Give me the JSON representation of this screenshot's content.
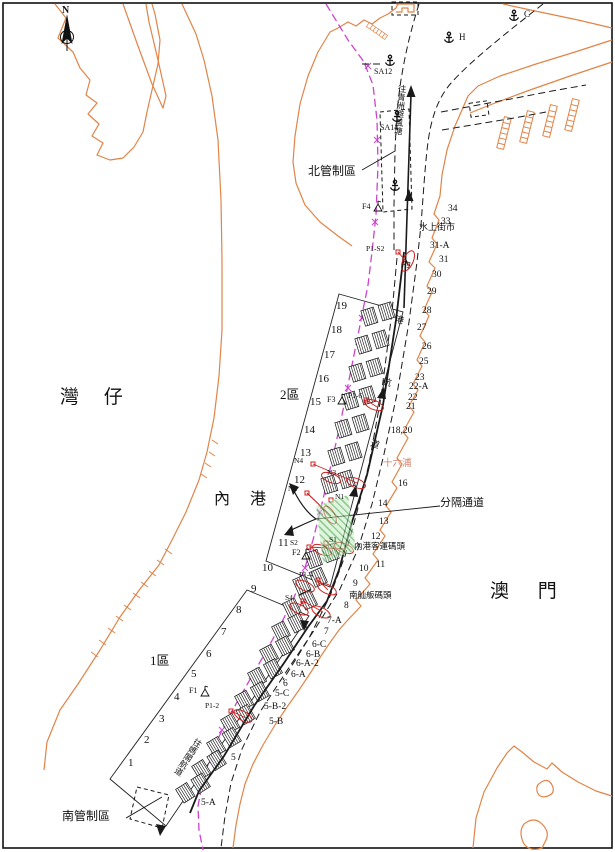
{
  "colors": {
    "coast": "#e08448",
    "boundary": "#cc44cc",
    "marker_red": "#cc2222",
    "separation_fill": "#c6ecc6",
    "separation_hatch": "#3aa53a",
    "line": "#1a1a1a"
  },
  "labels": [
    {
      "n": "compass-label",
      "t": "N",
      "x": 62,
      "y": 6,
      "s": 10,
      "b": 1
    },
    {
      "n": "region-wanzai",
      "t": "灣 仔",
      "x": 60,
      "y": 388,
      "s": 19,
      "ls": 10
    },
    {
      "n": "region-neigang",
      "t": "內 港",
      "x": 214,
      "y": 492,
      "s": 16,
      "ls": 8
    },
    {
      "n": "region-aomen",
      "t": "澳 門",
      "x": 490,
      "y": 582,
      "s": 19,
      "ls": 12
    },
    {
      "n": "zone-2-label",
      "t": "2區",
      "x": 280,
      "y": 388,
      "s": 13
    },
    {
      "n": "zone-1-label",
      "t": "1區",
      "x": 150,
      "y": 654,
      "s": 13
    },
    {
      "n": "north-control-zone-label",
      "t": "北管制區",
      "x": 308,
      "y": 165,
      "s": 12
    },
    {
      "n": "south-control-zone-label",
      "t": "南管制區",
      "x": 62,
      "y": 810,
      "s": 12
    },
    {
      "n": "separation-channel-label",
      "t": "分隔通道",
      "x": 440,
      "y": 498,
      "s": 11
    },
    {
      "n": "water-street-market-label",
      "t": "水上街市",
      "x": 419,
      "y": 223,
      "s": 9
    },
    {
      "n": "ponte16-label",
      "t": "十六浦",
      "x": 383,
      "y": 460,
      "s": 9.5,
      "c": "#d4826a"
    },
    {
      "n": "inner-harbour-ferry-pier-label",
      "t": "內港客運碼頭",
      "x": 354,
      "y": 542,
      "s": 8.5
    },
    {
      "n": "south-sampan-pier-label",
      "t": "南舢舨碼頭",
      "x": 349,
      "y": 591,
      "s": 8.5
    },
    {
      "n": "to-qingzhou-shelter-label",
      "t": "往青洲避風塘",
      "x": 398,
      "y": 84,
      "s": 8.5,
      "v": 1,
      "r": 5
    },
    {
      "n": "channel-name-char",
      "t": "內",
      "x": 403,
      "y": 259,
      "s": 9,
      "r": 15
    },
    {
      "n": "channel-name-char",
      "t": "港",
      "x": 396,
      "y": 315,
      "s": 9,
      "r": 15
    },
    {
      "n": "channel-name-char",
      "t": "航",
      "x": 384,
      "y": 377,
      "s": 9,
      "r": 18
    },
    {
      "n": "channel-name-char",
      "t": "道",
      "x": 372,
      "y": 439,
      "s": 9,
      "r": 18
    },
    {
      "n": "to-mage-channel-label",
      "t": "往媽閣航道",
      "x": 196,
      "y": 737,
      "s": 8.5,
      "v": 1,
      "r": 33
    },
    {
      "n": "anchorage-c-label",
      "t": "C",
      "x": 524,
      "y": 10,
      "s": 9
    },
    {
      "n": "anchorage-h-label",
      "t": "H",
      "x": 459,
      "y": 33,
      "s": 9
    },
    {
      "n": "marker-sa12-label",
      "t": "SA12",
      "x": 374,
      "y": 68,
      "s": 8
    },
    {
      "n": "marker-sa14-label",
      "t": "SA14",
      "x": 380,
      "y": 124,
      "s": 8
    },
    {
      "n": "marker-f4-label",
      "t": "F4",
      "x": 362,
      "y": 203,
      "s": 8
    },
    {
      "n": "marker-f3-label",
      "t": "F3",
      "x": 327,
      "y": 396,
      "s": 8
    },
    {
      "n": "marker-f2-label",
      "t": "F2",
      "x": 292,
      "y": 549,
      "s": 8
    },
    {
      "n": "marker-f1-label",
      "t": "F1",
      "x": 189,
      "y": 687,
      "s": 8
    },
    {
      "n": "marker-n4-label",
      "t": "N4",
      "x": 294,
      "y": 457,
      "s": 7.5
    },
    {
      "n": "marker-n3-label",
      "t": "N3",
      "x": 327,
      "y": 469,
      "s": 7.5
    },
    {
      "n": "marker-n2-label",
      "t": "N2",
      "x": 288,
      "y": 485,
      "s": 7.5
    },
    {
      "n": "marker-n1-label",
      "t": "N1",
      "x": 335,
      "y": 493,
      "s": 7.5
    },
    {
      "n": "marker-s2-label",
      "t": "S2",
      "x": 290,
      "y": 539,
      "s": 7.5
    },
    {
      "n": "marker-s1-label",
      "t": "S1",
      "x": 329,
      "y": 536,
      "s": 7.5
    },
    {
      "n": "marker-s4-label",
      "t": "S4",
      "x": 285,
      "y": 594,
      "s": 7.5
    },
    {
      "n": "marker-p1s2-label",
      "t": "P1-S2",
      "x": 366,
      "y": 245,
      "s": 7.5
    },
    {
      "n": "marker-p1-6-label",
      "t": "P1-6",
      "x": 348,
      "y": 392,
      "s": 7.5
    },
    {
      "n": "marker-p1-4-label",
      "t": "P1-4",
      "x": 299,
      "y": 571,
      "s": 7.5
    },
    {
      "n": "marker-p1-2-label",
      "t": "P1-2",
      "x": 205,
      "y": 702,
      "s": 7.5
    },
    {
      "n": "berth-19",
      "t": "19",
      "x": 336,
      "y": 301,
      "s": 11
    },
    {
      "n": "berth-18",
      "t": "18",
      "x": 331,
      "y": 325,
      "s": 11
    },
    {
      "n": "berth-17",
      "t": "17",
      "x": 324,
      "y": 350,
      "s": 11
    },
    {
      "n": "berth-16",
      "t": "16",
      "x": 318,
      "y": 374,
      "s": 11
    },
    {
      "n": "berth-15",
      "t": "15",
      "x": 310,
      "y": 397,
      "s": 11
    },
    {
      "n": "berth-14",
      "t": "14",
      "x": 304,
      "y": 425,
      "s": 11
    },
    {
      "n": "berth-13",
      "t": "13",
      "x": 300,
      "y": 448,
      "s": 11
    },
    {
      "n": "berth-12",
      "t": "12",
      "x": 294,
      "y": 475,
      "s": 11
    },
    {
      "n": "berth-11",
      "t": "11",
      "x": 278,
      "y": 538,
      "s": 11
    },
    {
      "n": "berth-10",
      "t": "10",
      "x": 262,
      "y": 563,
      "s": 11
    },
    {
      "n": "berth-9",
      "t": "9",
      "x": 251,
      "y": 584,
      "s": 11
    },
    {
      "n": "berth-8",
      "t": "8",
      "x": 236,
      "y": 605,
      "s": 11
    },
    {
      "n": "berth-7",
      "t": "7",
      "x": 221,
      "y": 627,
      "s": 11
    },
    {
      "n": "berth-6",
      "t": "6",
      "x": 206,
      "y": 649,
      "s": 11
    },
    {
      "n": "berth-5",
      "t": "5",
      "x": 191,
      "y": 669,
      "s": 11
    },
    {
      "n": "berth-4",
      "t": "4",
      "x": 174,
      "y": 692,
      "s": 11
    },
    {
      "n": "berth-3",
      "t": "3",
      "x": 159,
      "y": 714,
      "s": 11
    },
    {
      "n": "berth-2",
      "t": "2",
      "x": 144,
      "y": 735,
      "s": 11
    },
    {
      "n": "berth-1",
      "t": "1",
      "x": 128,
      "y": 758,
      "s": 11
    },
    {
      "n": "quay-34",
      "t": "34",
      "x": 448,
      "y": 205,
      "s": 9.5
    },
    {
      "n": "quay-33",
      "t": "33",
      "x": 441,
      "y": 218,
      "s": 9.5
    },
    {
      "n": "quay-31a",
      "t": "31-A",
      "x": 430,
      "y": 242,
      "s": 9.5
    },
    {
      "n": "quay-31",
      "t": "31",
      "x": 439,
      "y": 256,
      "s": 9.5
    },
    {
      "n": "quay-30",
      "t": "30",
      "x": 432,
      "y": 271,
      "s": 9.5
    },
    {
      "n": "quay-29",
      "t": "29",
      "x": 427,
      "y": 288,
      "s": 9.5
    },
    {
      "n": "quay-28",
      "t": "28",
      "x": 422,
      "y": 307,
      "s": 9.5
    },
    {
      "n": "quay-27",
      "t": "27",
      "x": 417,
      "y": 324,
      "s": 9.5
    },
    {
      "n": "quay-26",
      "t": "26",
      "x": 422,
      "y": 343,
      "s": 9.5
    },
    {
      "n": "quay-25",
      "t": "25",
      "x": 419,
      "y": 358,
      "s": 9.5
    },
    {
      "n": "quay-23",
      "t": "23",
      "x": 415,
      "y": 374,
      "s": 9.5
    },
    {
      "n": "quay-22a",
      "t": "22-A",
      "x": 409,
      "y": 383,
      "s": 9.5
    },
    {
      "n": "quay-22",
      "t": "22",
      "x": 408,
      "y": 394,
      "s": 9.5
    },
    {
      "n": "quay-21",
      "t": "21",
      "x": 406,
      "y": 403,
      "s": 9.5
    },
    {
      "n": "quay-18-20",
      "t": "18,20",
      "x": 391,
      "y": 427,
      "s": 9.5
    },
    {
      "n": "quay-16",
      "t": "16",
      "x": 398,
      "y": 480,
      "s": 9.5
    },
    {
      "n": "quay-14",
      "t": "14",
      "x": 378,
      "y": 500,
      "s": 9.5
    },
    {
      "n": "quay-13",
      "t": "13",
      "x": 379,
      "y": 518,
      "s": 9.5
    },
    {
      "n": "quay-12",
      "t": "12",
      "x": 371,
      "y": 533,
      "s": 9.5
    },
    {
      "n": "quay-11",
      "t": "11",
      "x": 376,
      "y": 561,
      "s": 9.5
    },
    {
      "n": "quay-10",
      "t": "10",
      "x": 359,
      "y": 565,
      "s": 9.5
    },
    {
      "n": "quay-9",
      "t": "9",
      "x": 353,
      "y": 580,
      "s": 9.5
    },
    {
      "n": "quay-8",
      "t": "8",
      "x": 344,
      "y": 602,
      "s": 9.5
    },
    {
      "n": "quay-7a",
      "t": "7-A",
      "x": 327,
      "y": 617,
      "s": 9.5
    },
    {
      "n": "quay-7",
      "t": "7",
      "x": 324,
      "y": 628,
      "s": 9.5
    },
    {
      "n": "quay-6c",
      "t": "6-C",
      "x": 312,
      "y": 641,
      "s": 9.5
    },
    {
      "n": "quay-6b",
      "t": "6-B",
      "x": 306,
      "y": 651,
      "s": 9.5
    },
    {
      "n": "quay-6a2",
      "t": "6-A-2",
      "x": 296,
      "y": 660,
      "s": 9.5
    },
    {
      "n": "quay-6a",
      "t": "6-A",
      "x": 291,
      "y": 671,
      "s": 9.5
    },
    {
      "n": "quay-6",
      "t": "6",
      "x": 283,
      "y": 680,
      "s": 9.5
    },
    {
      "n": "quay-5c",
      "t": "5-C",
      "x": 275,
      "y": 690,
      "s": 9.5
    },
    {
      "n": "quay-5b2",
      "t": "5-B-2",
      "x": 264,
      "y": 703,
      "s": 9.5
    },
    {
      "n": "quay-5b",
      "t": "5-B",
      "x": 269,
      "y": 718,
      "s": 9.5
    },
    {
      "n": "quay-5",
      "t": "5",
      "x": 231,
      "y": 754,
      "s": 9.5
    },
    {
      "n": "quay-5a",
      "t": "5-A",
      "x": 201,
      "y": 799,
      "s": 9.5
    }
  ]
}
